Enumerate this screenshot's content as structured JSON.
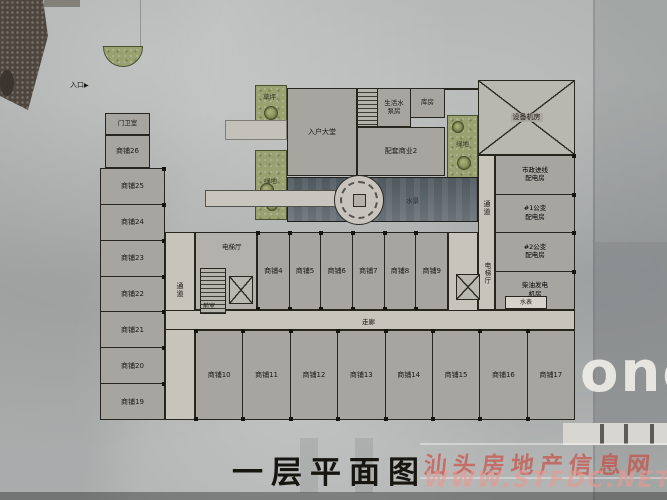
{
  "meta": {
    "caption": "一层平面图",
    "watermark": {
      "line1": "汕头房地产信息网",
      "line2": "WWW.STFDC.NET"
    },
    "sign": "ono"
  },
  "colors": {
    "watermark_red": "#cf3a30",
    "lawn_green": "#9aa171",
    "pool_slate": "#5d666d"
  },
  "plan": {
    "entrance": "入口",
    "gatehouse": "门卫室",
    "notch_shop": "商铺26",
    "left_shops": [
      "商铺25",
      "商铺24",
      "商铺23",
      "商铺22",
      "商铺21",
      "商铺20",
      "商铺19"
    ],
    "lobby": "入户大堂",
    "pump": {
      "l1": "生活水",
      "l2": "泵房"
    },
    "storage": "库房",
    "retail2": "配套商业2",
    "lawn_top": "草坪",
    "lawn_mid": "绿地",
    "lawn_right": "绿地",
    "pool": "水景",
    "equipment": "设备机房",
    "corridor_right": "通道",
    "elev_hall_right": "电梯厅",
    "utility_rooms": [
      {
        "l1": "市政进线",
        "l2": "配电房"
      },
      {
        "l1": "#1公变",
        "l2": "配电房"
      },
      {
        "l1": "#2公变",
        "l2": "配电房"
      },
      {
        "l1": "柴油发电",
        "l2": "机房"
      }
    ],
    "water_meter": "水表",
    "corridor_left": "通道",
    "elev_hall_left": "电梯厅",
    "vestibule": "前室",
    "corridor_main": "走廊",
    "upper_shops": [
      "商铺4",
      "商铺5",
      "商铺6",
      "商铺7",
      "商铺8",
      "商铺9"
    ],
    "lower_shops": [
      "商铺10",
      "商铺11",
      "商铺12",
      "商铺13",
      "商铺14",
      "商铺15",
      "商铺16",
      "商铺17"
    ]
  }
}
